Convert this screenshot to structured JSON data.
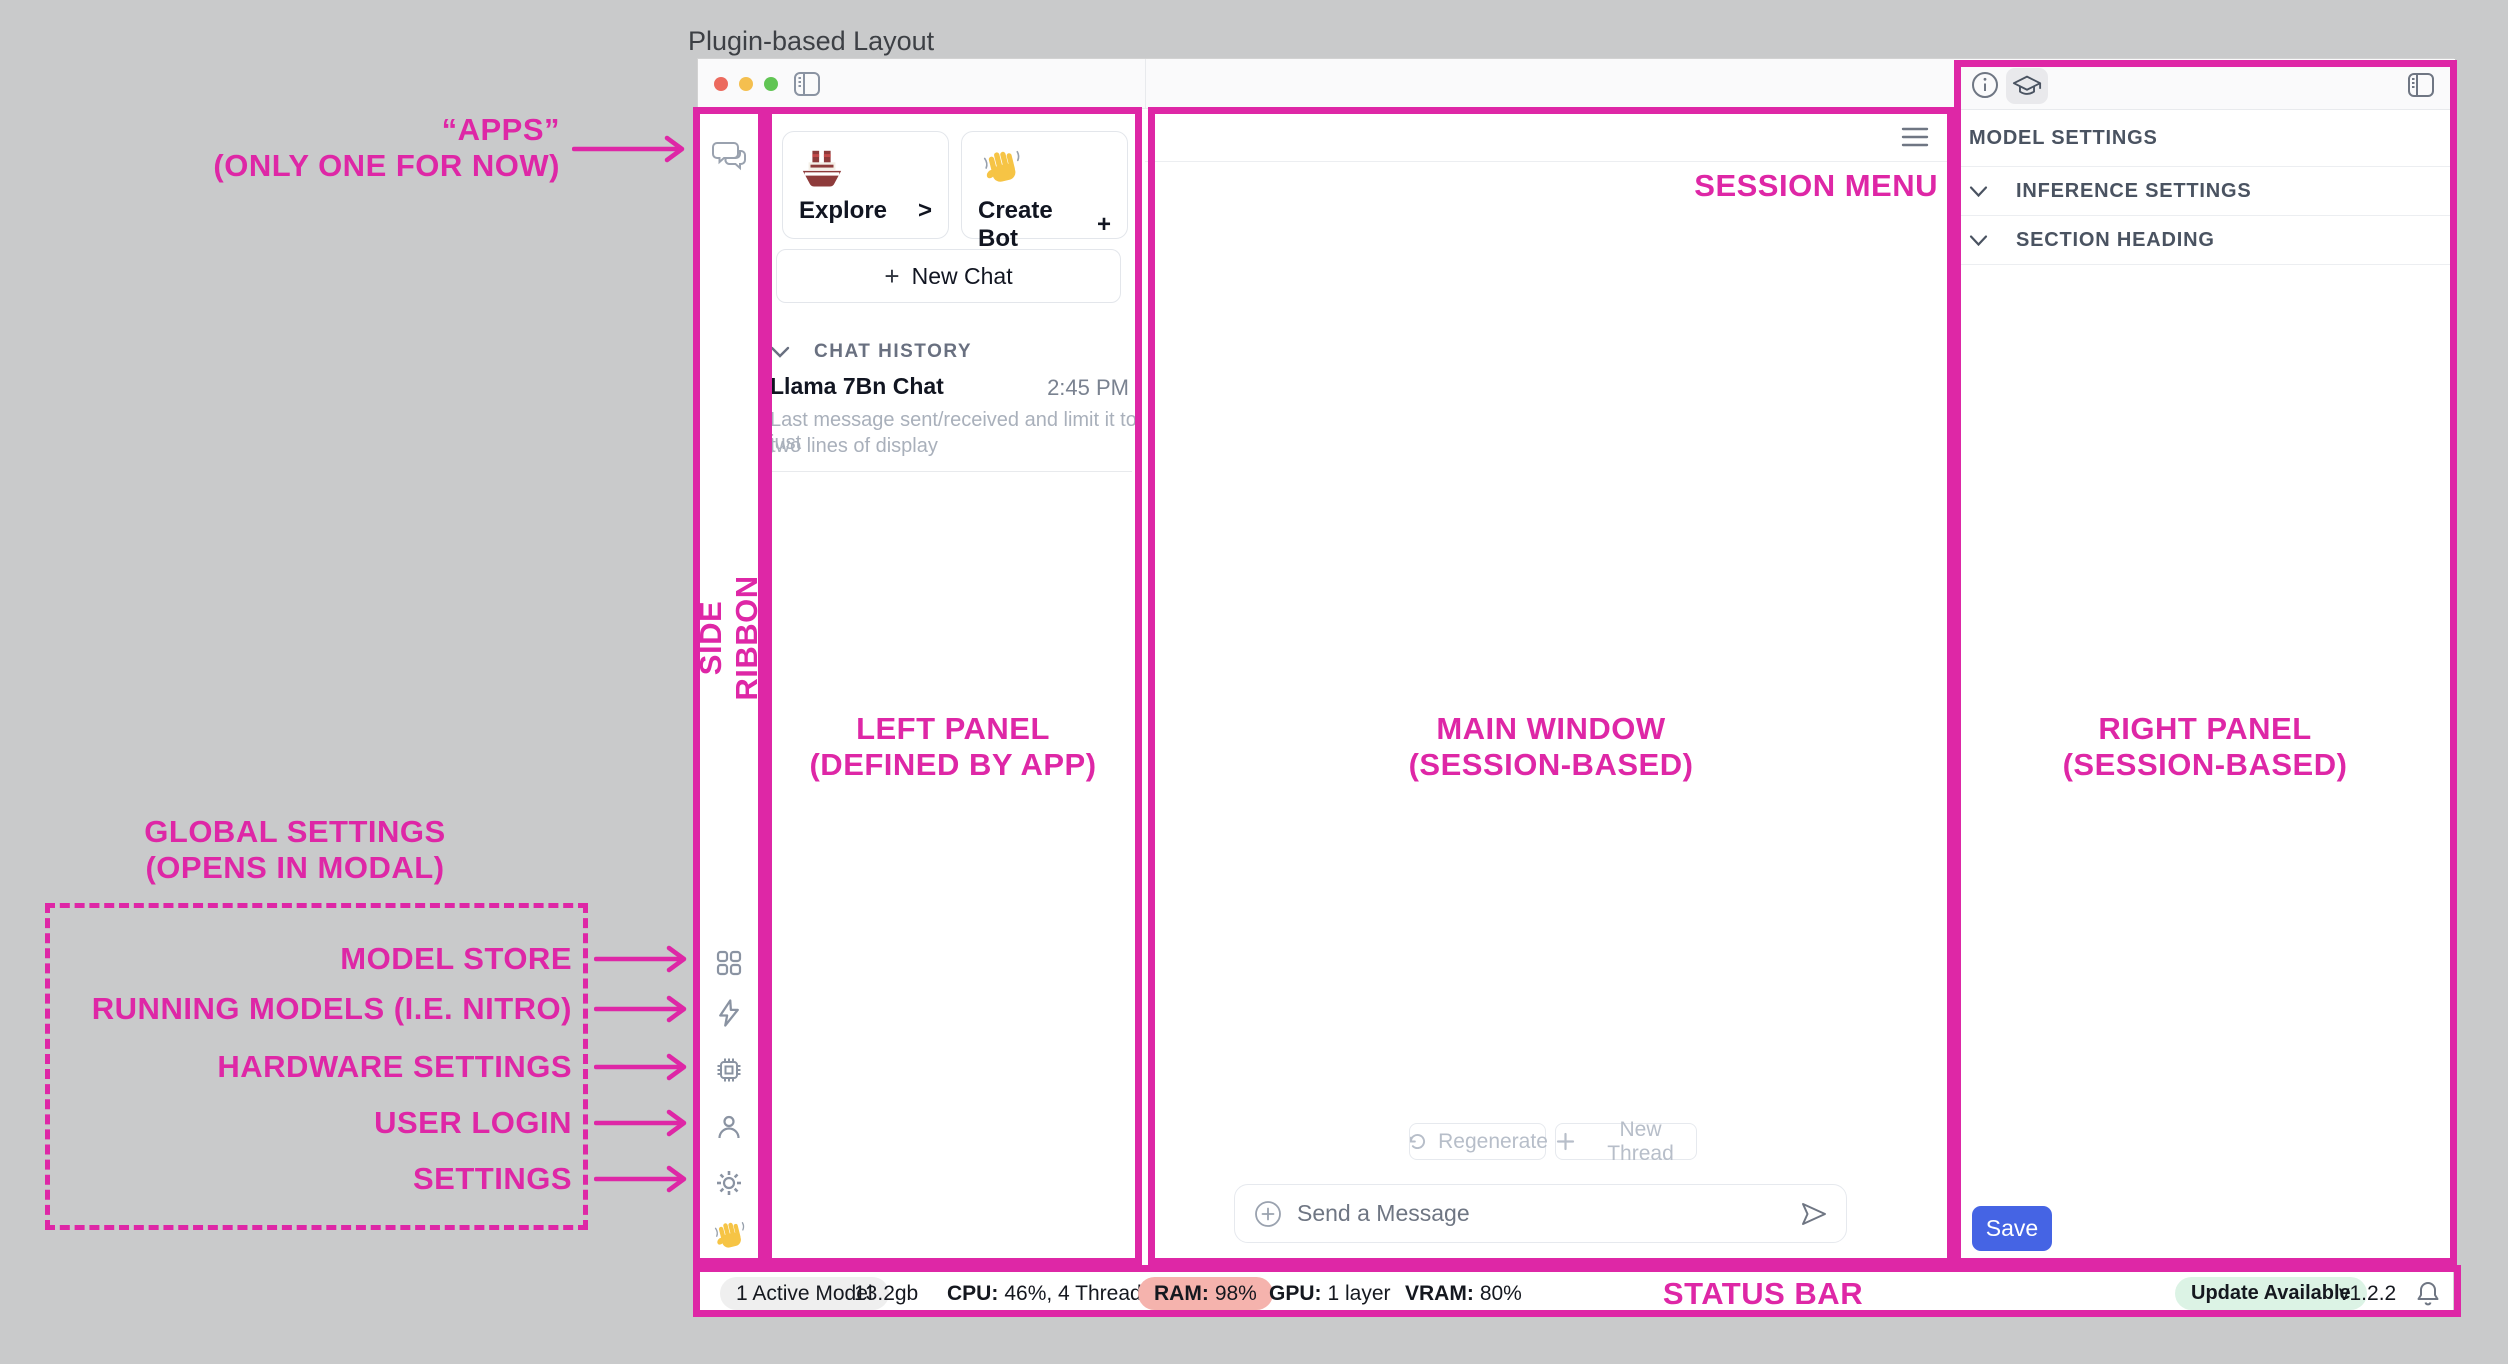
{
  "page_title": "Plugin-based Layout",
  "annotations": {
    "accent_color": "#DE27A6",
    "apps_line1": "“APPS”",
    "apps_line2": "(ONLY ONE FOR NOW)",
    "side_ribbon": "SIDE RIBBON",
    "left_panel_line1": "LEFT PANEL",
    "left_panel_line2": "(DEFINED BY APP)",
    "main_window_line1": "MAIN WINDOW",
    "main_window_line2": "(SESSION-BASED)",
    "right_panel_line1": "RIGHT PANEL",
    "right_panel_line2": "(SESSION-BASED)",
    "session_menu": "SESSION MENU",
    "status_bar": "STATUS BAR",
    "global_settings_line1": "GLOBAL SETTINGS",
    "global_settings_line2": "(OPENS IN MODAL)",
    "ribbon_items": [
      {
        "label": "MODEL STORE"
      },
      {
        "label": "RUNNING MODELS (I.E. NITRO)"
      },
      {
        "label": "HARDWARE SETTINGS"
      },
      {
        "label": "USER LOGIN"
      },
      {
        "label": "SETTINGS"
      }
    ]
  },
  "left_panel": {
    "cards": [
      {
        "icon": "ship-emoji",
        "label": "Explore",
        "affix": ">"
      },
      {
        "icon": "wave-emoji",
        "label": "Create Bot",
        "affix": "+"
      }
    ],
    "new_chat_plus": "+",
    "new_chat_label": "New Chat",
    "history_header": "CHAT HISTORY",
    "chat_item": {
      "title": "Llama 7Bn Chat",
      "time": "2:45 PM",
      "preview_line1": "Last message sent/received and limit it to just",
      "preview_line2": "two lines of display"
    }
  },
  "main": {
    "regenerate_label": "Regenerate",
    "new_thread_label": "New Thread",
    "composer_placeholder": "Send a Message"
  },
  "right_panel": {
    "header": "MODEL SETTINGS",
    "sections": [
      {
        "label": "INFERENCE SETTINGS"
      },
      {
        "label": "SECTION HEADING"
      }
    ],
    "save_label": "Save"
  },
  "status_bar": {
    "active_models": "1 Active Model",
    "memory": "13.2gb",
    "cpu_label": "CPU:",
    "cpu_value": "46%, 4 Threads",
    "ram_label": "RAM:",
    "ram_value": "98%",
    "gpu_label": "GPU:",
    "gpu_value": "1 layer",
    "vram_label": "VRAM:",
    "vram_value": "80%",
    "update_badge": "Update Available",
    "version": "v1.2.2"
  }
}
